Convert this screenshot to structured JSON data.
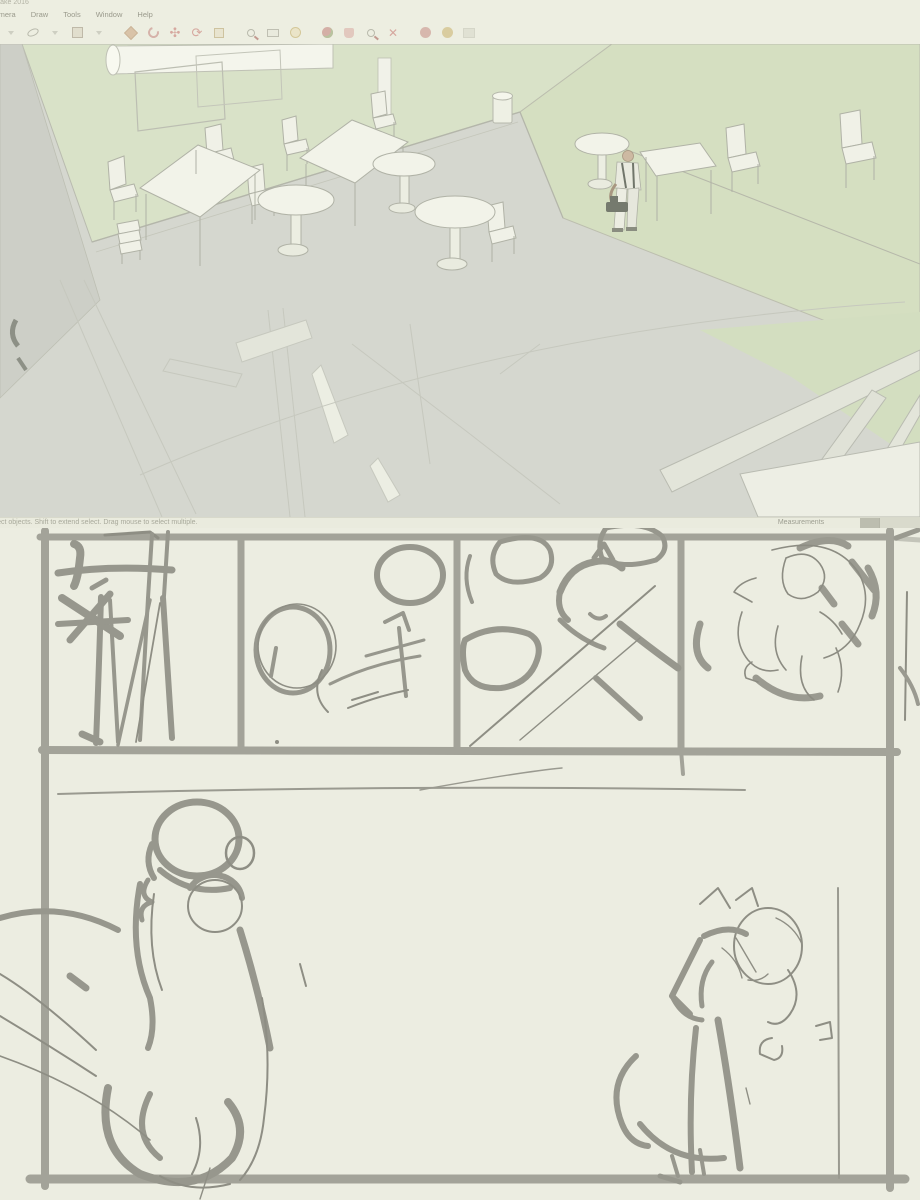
{
  "window": {
    "title": "SketchUp Make 2016",
    "menu_items": [
      "Camera",
      "Draw",
      "Tools",
      "Window",
      "Help"
    ],
    "toolbar_tools": [
      "select-caret",
      "eraser",
      "eraser-caret",
      "paint-bucket",
      "paint-bucket-caret",
      "push-pull",
      "follow-me",
      "move",
      "rotate",
      "scale",
      "zoom-window",
      "tape-measure",
      "protractor",
      "orbit",
      "pan",
      "zoom",
      "zoom-extents",
      "shadows",
      "views",
      "disabled-tool"
    ],
    "status": {
      "hint": "Select objects. Shift to extend select. Drag mouse to select multiple.",
      "measurements_label": "Measurements"
    }
  },
  "scene": {
    "objects": [
      "green-wall",
      "rolled-projection-screen",
      "whiteboard",
      "gray-floor",
      "green-floor",
      "square-table",
      "square-table",
      "square-table",
      "round-pedestal-table",
      "round-pedestal-table",
      "round-pedestal-table",
      "round-pedestal-table",
      "chairs",
      "stacked-chairs",
      "trash-can",
      "human-figure",
      "lower-floor-wireframe",
      "doorframe-beams"
    ]
  },
  "sketch_page": {
    "rows": 2,
    "panels": [
      {
        "id": 1,
        "content": "rough-sketch-vertical-linework-figure"
      },
      {
        "id": 2,
        "content": "rough-sketch-circles-and-arrow"
      },
      {
        "id": 3,
        "content": "rough-sketch-reclining-creature-and-blobs"
      },
      {
        "id": 4,
        "content": "rough-sketch-hunched-figure"
      },
      {
        "id": 5,
        "content": "large-panel-seated-person-from-behind-and-sitting-dog-with-ponytail-head"
      }
    ]
  },
  "colors": {
    "canvas_bg": "#ecede1",
    "viewport_floor_gray": "#d5d7cf",
    "wall_green": "#d9e2c8",
    "floor_green": "#d5dfc1",
    "furniture_white": "#f0f1e7",
    "sketch_stroke": "#97978d",
    "sketch_border": "#a3a399",
    "status_text": "#a8a99b"
  }
}
